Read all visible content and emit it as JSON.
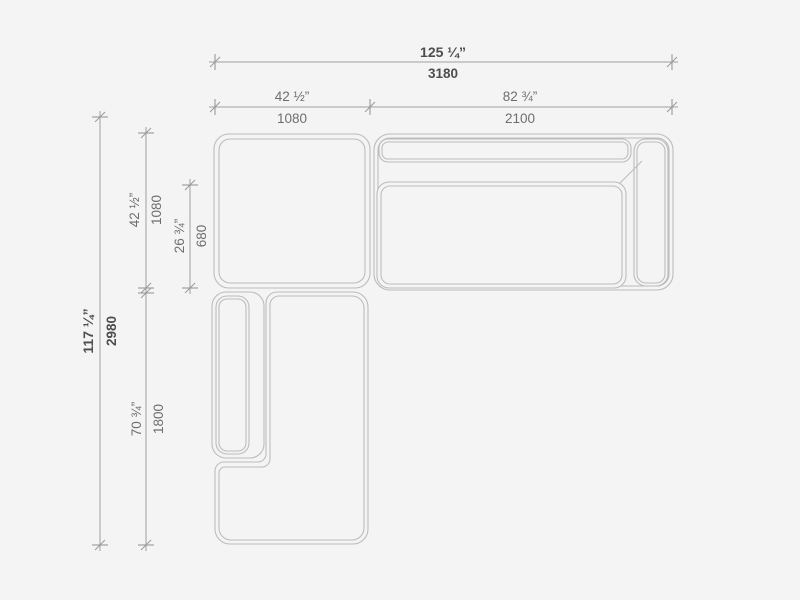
{
  "page": {
    "background_color": "#f4f4f4"
  },
  "drawing": {
    "kind": "sectional-sofa-plan-view-dimension-diagram",
    "colors": {
      "furniture_outline": "#bcbcbc",
      "dimension_line": "#9f9f9f",
      "text_primary": "#4d4d4d",
      "text_secondary": "#6e6e6e"
    },
    "dimensions": {
      "total_width": {
        "inches": "125 ¼”",
        "mm": "3180"
      },
      "left_section_width": {
        "inches": "42 ½”",
        "mm": "1080"
      },
      "right_section_width": {
        "inches": "82 ¾”",
        "mm": "2100"
      },
      "total_depth": {
        "inches": "117 ¼”",
        "mm": "2980"
      },
      "corner_module_depth": {
        "inches": "42 ½”",
        "mm": "1080"
      },
      "seat_depth": {
        "inches": "26 ¾”",
        "mm": "680"
      },
      "chaise_length": {
        "inches": "70 ¾”",
        "mm": "1800"
      }
    }
  }
}
